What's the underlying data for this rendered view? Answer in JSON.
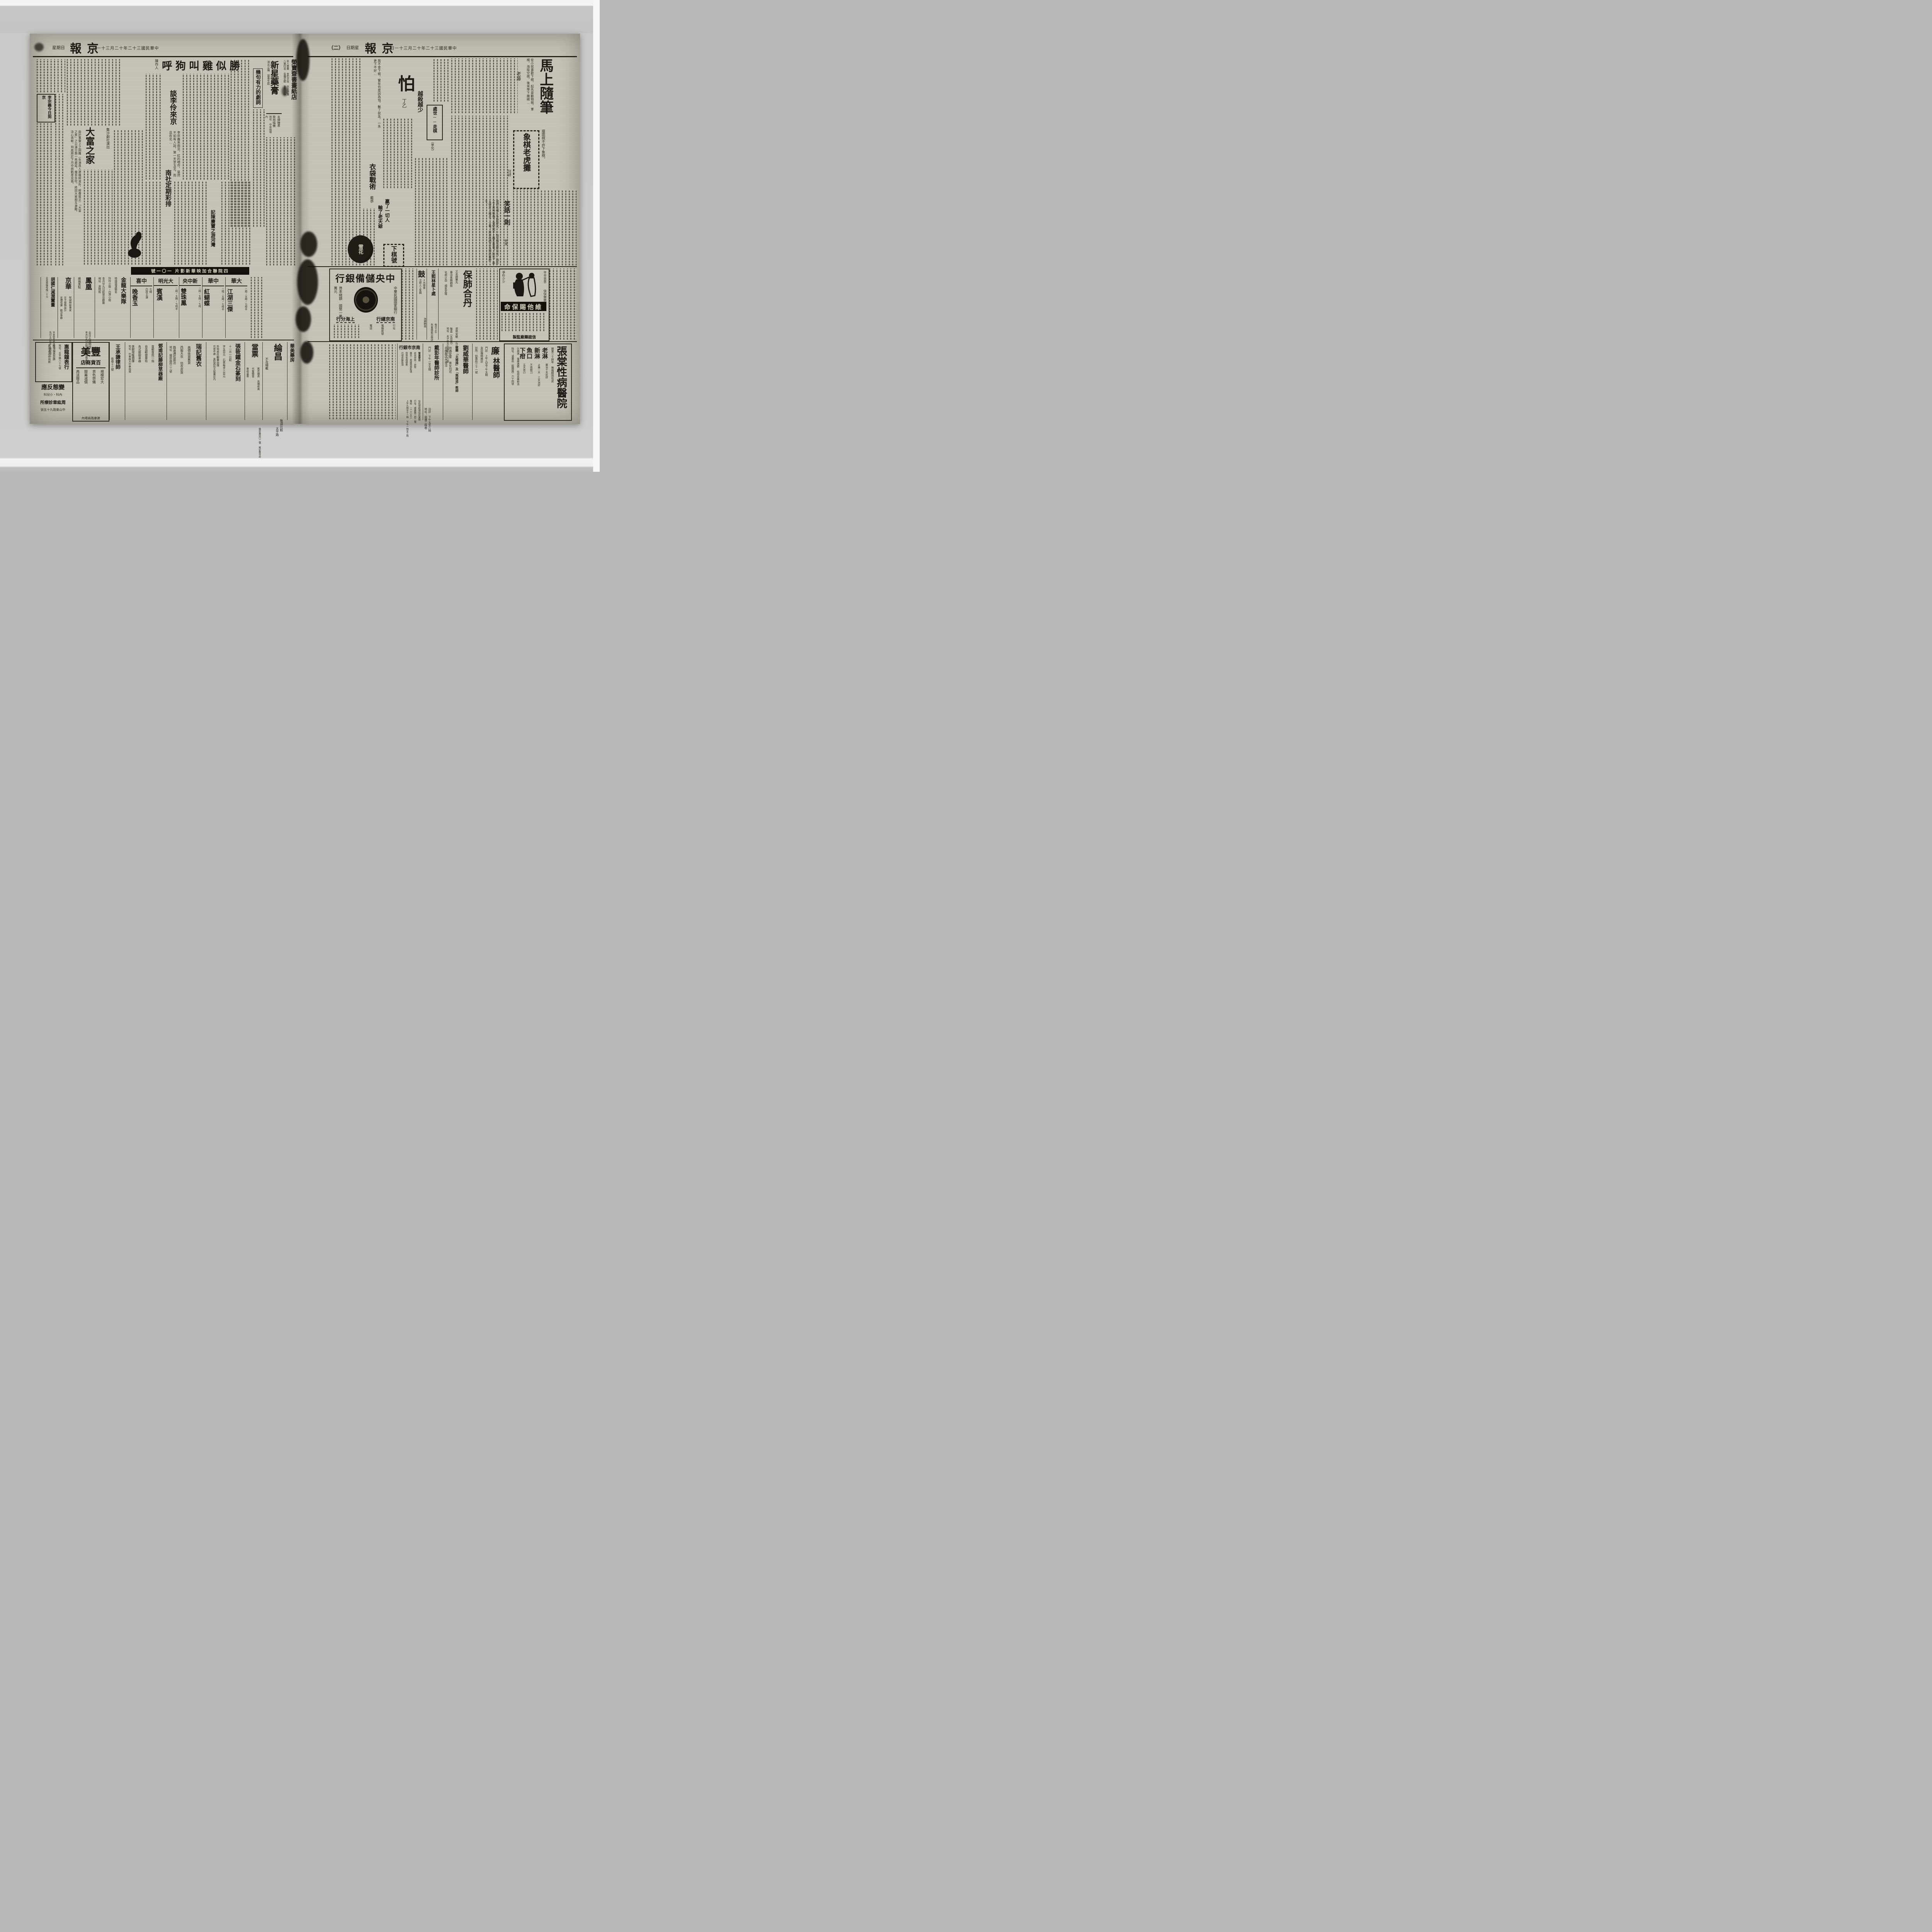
{
  "colors": {
    "paper": "#c8c4b9",
    "ink": "#1d1a15",
    "bed_gray": "#c7c7c5",
    "stripe_white": "#f3f3f1"
  },
  "masthead": {
    "title": "京報",
    "date": "中華民國三十二年十二月三十一日",
    "weekday": "星期日",
    "page_marker": "（二）"
  },
  "left": {
    "a_juju": "幾句有力的劇詞",
    "a_sheng": {
      "title": "勝似雞叫狗呼",
      "author": "陳作人"
    },
    "a_lizong": "李宗義今日到京",
    "a_tanli": {
      "title": "談李伶來京",
      "excerpt": "李宗義來南京，紅的唱作，當然不如有人說，第一天李玉芝，而且在北…"
    },
    "a_dafu": {
      "kicker": "集沙劇社演出",
      "title": "大富之家",
      "excerpt": "由於事實上之困難（女演員人選幾經波折，經費貧乏）「大富之家」之公演日期一再遲延，幾至告吹，終因大家相互激勵，決心苦幹，到底將於下月中與觀眾見面。"
    },
    "a_nanshe": "南社定期彩排",
    "a_jichen": "記陳賡寶之游河灣",
    "ad_rong": {
      "title": "榮寶齋書畫紙店",
      "l1": "名人書畫 金石文玩 仿古詩箋",
      "l2": "八寶印泥 各種宣紙 喜壽屏聯",
      "l3": "電話 二三二四七號"
    },
    "ad_xinxing": {
      "title": "新星藥膏",
      "slogan": "消炎止痛 拔毒生肌"
    },
    "ad_gelin": {
      "l1": "名牌鐘表",
      "l2": "歌林唱機",
      "l3": "地址 中央商場內"
    },
    "banner": "四院聯合加映華新影片 一〇一號",
    "t_dahua": {
      "name": "大華",
      "times": "二時・五時・七時半",
      "film": "江湖三傑"
    },
    "t_zhonghua": {
      "name": "中華",
      "times": "二時・五時・七時半",
      "film": "紅蝴蝶"
    },
    "t_xzy": {
      "name": "新中央",
      "times": "二時・五時・七時",
      "film": "雙珠鳳"
    },
    "t_dgm": {
      "name": "大光明",
      "times": "二時・五時・七時半",
      "film": "賓漢"
    },
    "t_zhongxi": {
      "name": "中喜",
      "times": "七時",
      "cast": "白玫主演",
      "film": "晚香玉"
    },
    "ad_jinlong": {
      "title": "金龍大樂隊",
      "l1": "特請滬漢馳名",
      "l2": "玲玲小姐・白萍小姐",
      "l3": "本月廿九日起登台獻藝",
      "l4": "地址 貢院街"
    },
    "ad_feng": {
      "title": "鳳凰",
      "l1": "維揚美點",
      "l2": "全日火鍋開放",
      "l3": "本月廿九日起早茶市供應名點"
    },
    "ad_jinghua": {
      "title": "京華",
      "l1": "呢絨時裝專家",
      "l2": "女子服飾設計",
      "l3": "定價低廉 歡迎參觀"
    },
    "ad_hu": {
      "title": "胡國仁減潤鬻畫",
      "l1": "花鳥條幅每幅一千元",
      "l2": "中堂依屏條加倍",
      "l3": "先付五日取件 隨封加二"
    },
    "ad_huilong": {
      "title": "惠龍鐘表行",
      "l1": "地址：太平路八十七號",
      "l2": "修理鐘表首飾",
      "l3": "舊壞表改修如新"
    },
    "ad_zhou": {
      "title": "變態反應",
      "l1": "內科・小兒科",
      "l2": "周紘章診療所",
      "l3": "中山東路九十五號"
    },
    "ad_meifeng": {
      "title": "美豐",
      "sub": "百貨商店",
      "l1": "規模宏大",
      "l2": "貨色齊備",
      "l3": "開幕減價",
      "l4": "再送贈品",
      "l5": "建康路商場內"
    },
    "ad_wang": {
      "title": "王承謙律師",
      "l1": "衛巷十三號"
    },
    "ad_deng": {
      "title": "鄧甫記藤柳草器廠",
      "l1": "首都首屈一指",
      "l2": "自造輕便華毯",
      "l3": "各式籐柳草器",
      "l4": "美觀增暖價廉",
      "l5": "地址 中華路大中華商場"
    },
    "ad_rui": {
      "title": "瑞記舊衣",
      "l1": "高價收買舊貨",
      "l2": "西服大衣 估衣皮貨",
      "l3": "路遠通信面洽",
      "l4": "地址 國府路四二二號"
    },
    "ad_zhangx": {
      "title": "張筱鐵金石篆刻",
      "l1": "十一月一日起",
      "l2": "字五百元 石質每字三百元",
      "l3": "外埠來件郵費自理",
      "l4": "代收件處 貢院西街大陸藥房內"
    },
    "ad_dang": {
      "title": "當票",
      "l1": "舊衣鐘表 高價收買",
      "l2": "代客贖當",
      "l3": "專收當票",
      "l4": "國府路四〇二號 維記舊貨店"
    },
    "ad_lun": {
      "title": "綸昌",
      "l1": "不及細載",
      "l2": "敬請比較",
      "l3": "太平路"
    },
    "ad_huamei": "華美藥房"
  },
  "right": {
    "a_ma": {
      "title": "馬上隨筆",
      "author": "老藤",
      "excerpt": "從小就喜歡下棋，起先是動物棋，軍棋，海陸空棋，後來學下圍棋…",
      "note": "擺圍棋不許下象棋。"
    },
    "a_xiangqi": {
      "title": "象棋老虎攤",
      "author": "阿野"
    },
    "a_xiaohua": {
      "title": "笑話一則",
      "author": "老身",
      "excerpt": "他們在樓上多麼斯文，一點兒聲音都沒有，相形之下真夠慚愧！我們何不上樓去看看？說完，兩人便走上樓去，一看，原來他們正互相扼着脖子。"
    },
    "a_pa": {
      "title": "怕",
      "author": "丁乙",
      "excerpt": "我不會下棋，實在也是因為怕，輸了就急，一急更下不好…"
    },
    "a_yue": "越殺越少",
    "a_chushi": {
      "title": "處世──走棋",
      "author": "（草化）"
    },
    "a_yidai": {
      "title": "衣袋戰術",
      "author": "戴恭"
    },
    "a_ying": {
      "t1": "贏了一切人",
      "t2": "輸了老天爺"
    },
    "a_xiaqi": {
      "title": "下棋號",
      "stamp": "雪花"
    },
    "ad_ccb": {
      "title": "中央儲備銀行",
      "subtitle": "中華民國國家銀行",
      "capital": "資本總額 國幣一萬萬元",
      "b1": "南京總行",
      "b2": "上海分行",
      "lab1": "行址",
      "lab2": "電報掛號",
      "lab3": "電話"
    },
    "ad_gulou": {
      "big": "鼓",
      "l1": "Ｘ光檢查",
      "l2": "注射人工氣胸",
      "l3": "治療肺病"
    },
    "ad_wxl": {
      "title": "王熙林星卜處",
      "l1": "每日上午",
      "l2": "朱雀路新亞飯店"
    },
    "ad_fei": {
      "title": "保肺合丹",
      "alt": "又名肺藥丸",
      "l1": "專治各期肺癆",
      "l2": "化痰止血 順氣定喘",
      "l3": "退熱安眠 止汗健胃",
      "l4": "每盒（五百元）",
      "l5": "地址 夫子廟大石壩街一〇八號"
    },
    "ad_weita": {
      "banner": "維他賜保命",
      "s1": "辛辛苦苦",
      "s2": "快快樂樂",
      "s3": "爭吵少少",
      "maker": "信誼藥廠監製"
    },
    "ad_nanshi": {
      "title": "南京市銀行",
      "l1": "營業要目",
      "l2": "收受存款・放款",
      "l3": "匯兌・票據買賣貼現",
      "l4": "買賣有價證券",
      "l5": "代理收解款項",
      "l6": "信託部經理信託業務",
      "l7": "行址：建康路二四二號",
      "l8": "電話 二二八五三",
      "l9": "上午九時至十二時 下午一時至三時"
    },
    "ad_dai": {
      "title": "戴彭年醫師診所",
      "l1": "門診 下午一至五時",
      "l2": "出診 下午五至八時",
      "l3": "地址：鼓樓二條巷"
    },
    "ad_liu": {
      "title": "劉威華醫師",
      "l1": "欲聘「太極操」及「無極道」教師",
      "l2": "待遇從豐 男女均可",
      "l3": "花園飯店內接洽"
    },
    "ad_lin": {
      "big": "廉",
      "title": "林醫師",
      "l1": "門診 上午九至下午五時",
      "l2": "急診隨時應診",
      "l3": "診所：鈔庫街三十一號"
    },
    "ad_zhangtang": {
      "title": "張棠性病醫院",
      "l1": "開業二十餘年 無痛精割包皮",
      "h1": "老淋",
      "d1": "藥治十天痊好",
      "h2": "新淋",
      "d2": "止痛一天 三天治好",
      "h3": "魚口",
      "d3": "不用開刀",
      "h4": "下疳",
      "d4": "五天收口",
      "l7": "久病淋 電療透膜 佐用良藥根治",
      "l8": "院址：道署街（臨園路）六十四號"
    }
  }
}
